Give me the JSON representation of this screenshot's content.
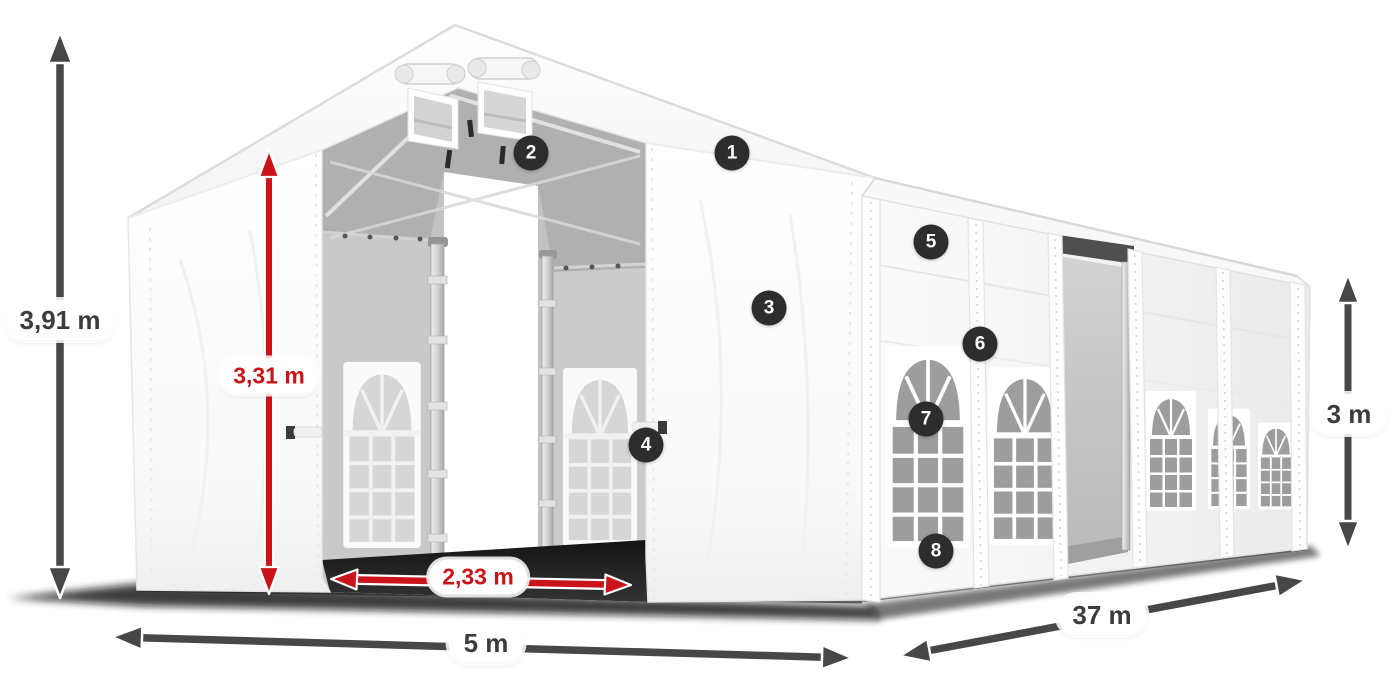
{
  "dimensions": {
    "total_height": "3,91 m",
    "entrance_height": "3,31 m",
    "entrance_width": "2,33 m",
    "front_width": "5 m",
    "length": "37 m",
    "side_height": "3 m"
  },
  "badges": [
    "1",
    "2",
    "3",
    "4",
    "5",
    "6",
    "7",
    "8"
  ],
  "colors": {
    "dimension_red": "#c9141a",
    "arrow_dark": "#474747",
    "badge_bg": "#2d2d2d",
    "label_text": "#3c3c3c",
    "pill_bg": "#ffffff"
  }
}
